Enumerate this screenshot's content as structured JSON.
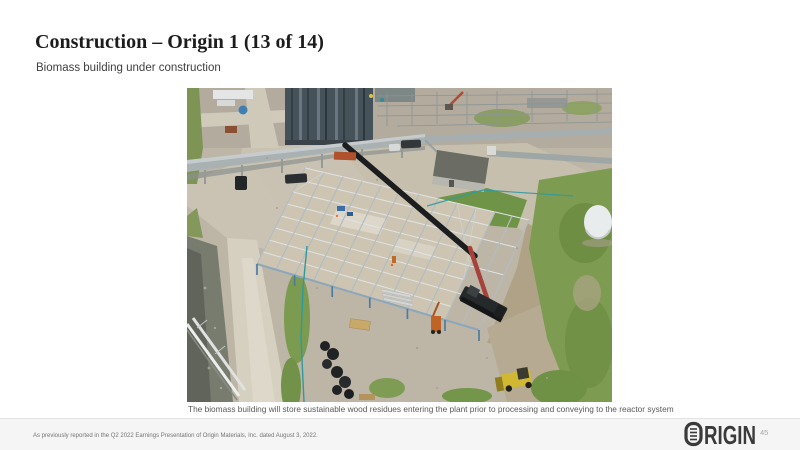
{
  "slide": {
    "title": "Construction – Origin 1 (13 of 14)",
    "subtitle": "Biomass building under construction",
    "photo_caption": "The biomass building will store sustainable wood residues entering the plant prior to processing and conveying to the reactor system",
    "footnote": "As previously reported in the Q2 2022 Earnings Presentation of Origin Materials, Inc. dated August 3, 2022.",
    "page_number": "45"
  },
  "logo": {
    "brand": "ORIGIN",
    "glyph_rest": "RIGIN"
  },
  "photo": {
    "description": "Aerial drone photo of the biomass building steel frame under construction at the Origin 1 plant site",
    "elements": [
      "steel-frame-building",
      "crane-with-red-boom",
      "black-pipe-being-lifted",
      "industrial-process-structures",
      "pipe-racks",
      "gravel-roads",
      "drainage-canal",
      "grass-areas",
      "utility-building",
      "white-storage-tank",
      "yellow-loader",
      "material-piles",
      "silt-fence"
    ]
  },
  "colors": {
    "title_text": "#1c1c1c",
    "subtitle_text": "#3f3f3f",
    "caption_text": "#595959",
    "footnote_text": "#747474",
    "footer_band": "#f5f5f5",
    "logo_charcoal": "#3a3a3a",
    "page_number_text": "#a8a8a8",
    "crane_red": "#a6423a",
    "steel_frame": "#c3ccd1",
    "grass_green": "#7d9c51",
    "silt_fence_teal": "#2d9aa0",
    "loader_yellow": "#d1b833"
  }
}
